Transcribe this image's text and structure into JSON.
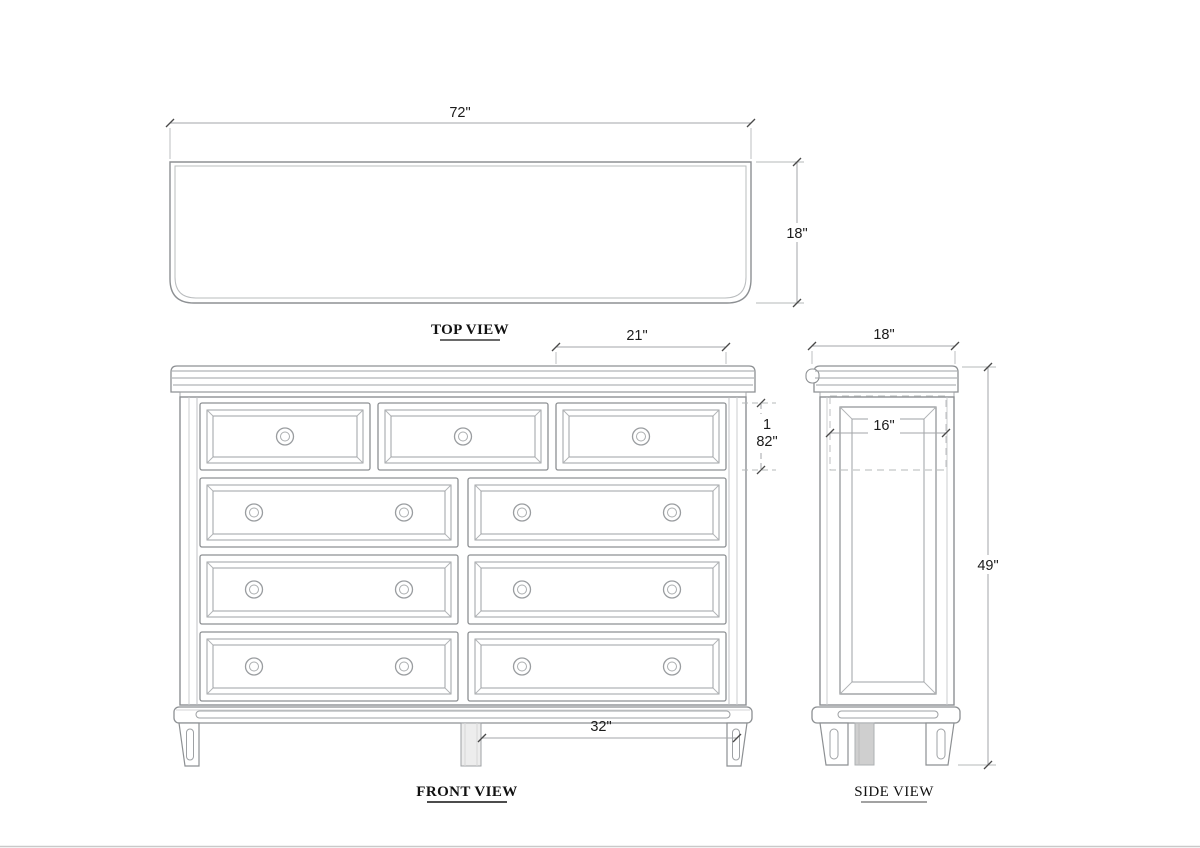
{
  "drawing": {
    "type": "furniture-dimension-drawing",
    "views": {
      "top_view": {
        "label": "TOP VIEW",
        "width_dim": "72\"",
        "depth_dim": "18\""
      },
      "front_view": {
        "label": "FRONT VIEW",
        "top_drawer_width_dim": "21\"",
        "drawer_height_dim_line1": "1",
        "drawer_height_dim_line2": "82\"",
        "leg_spacing_dim": "32\""
      },
      "side_view": {
        "label": "SIDE VIEW",
        "depth_dim": "18\"",
        "drawer_depth_dim": "16\"",
        "height_dim": "49\""
      }
    },
    "colors": {
      "background": "#ffffff",
      "object_line": "#8d9093",
      "object_line_light": "#b9bcbe",
      "dim_line": "#a3a6a8",
      "tick": "#4a4a4a",
      "dim_text": "#1b1b1b",
      "label_text": "#111111",
      "leg_shade": "#cfcfcf",
      "bottom_edge": "#c9c9c9"
    }
  }
}
